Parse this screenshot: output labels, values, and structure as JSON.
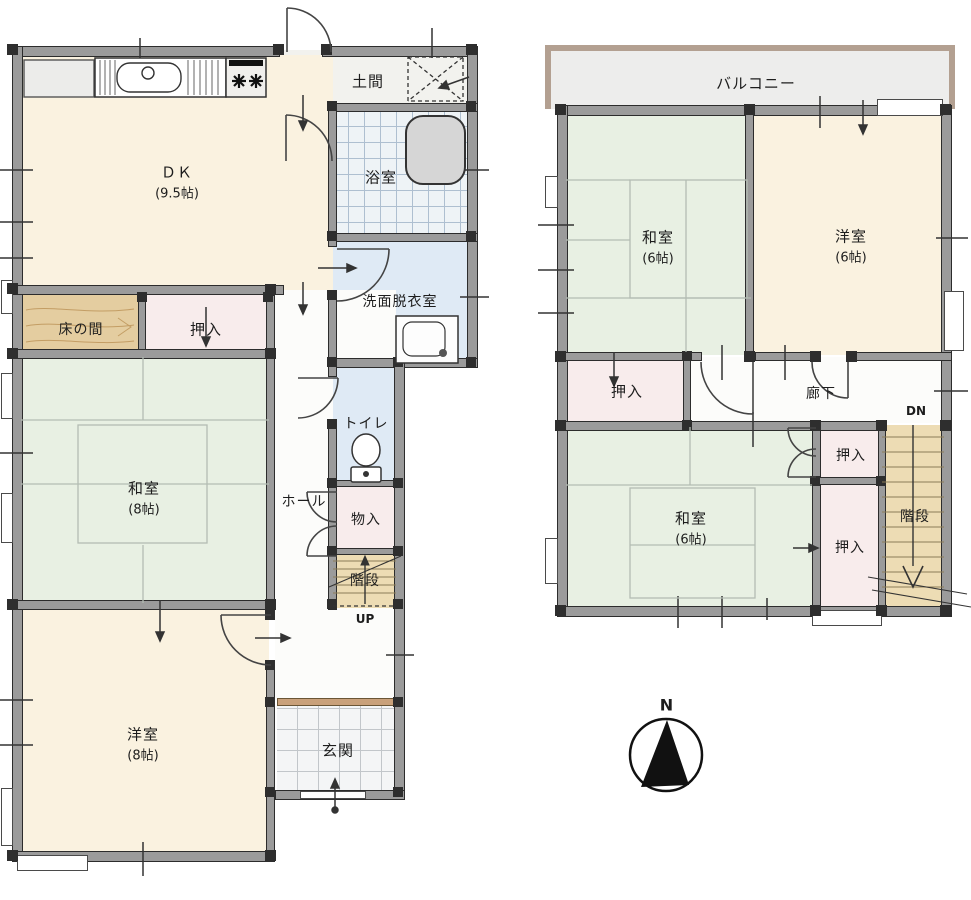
{
  "f1": {
    "doma": "土間",
    "bath": "浴室",
    "senmen": "洗面脱衣室",
    "dk": "ＤＫ",
    "dk_size": "(9.5帖)",
    "tokonoma": "床の間",
    "oshiire": "押入",
    "washitsu": "和室",
    "washitsu_size": "(8帖)",
    "toilet": "トイレ",
    "hall": "ホール",
    "monoire": "物入",
    "kaidan": "階段",
    "up": "UP",
    "yoshitsu": "洋室",
    "yoshitsu_size": "(8帖)",
    "genkan": "玄関"
  },
  "f2": {
    "balcony": "バルコニー",
    "washitsu_n": "和室",
    "washitsu_n_size": "(6帖)",
    "yoshitsu": "洋室",
    "yoshitsu_size": "(6帖)",
    "oshiire_nw": "押入",
    "rouka": "廊下",
    "dn": "DN",
    "washitsu_s": "和室",
    "washitsu_s_size": "(6帖)",
    "oshiire_e1": "押入",
    "oshiire_e2": "押入",
    "kaidan": "階段"
  },
  "compass": {
    "north": "N"
  },
  "colors": {
    "wall": "#9b9b9b",
    "cream": "#faf2e0",
    "tatami": "#e8f0e3",
    "closet": "#f8ecec",
    "wood": "#e4cda0",
    "water": "#dfeaf5",
    "stair": "#eddcb4",
    "doma": "#f2f2ee",
    "hallw": "#fcfcfa",
    "balwall": "#b3a091",
    "step": "#c9a17b"
  }
}
